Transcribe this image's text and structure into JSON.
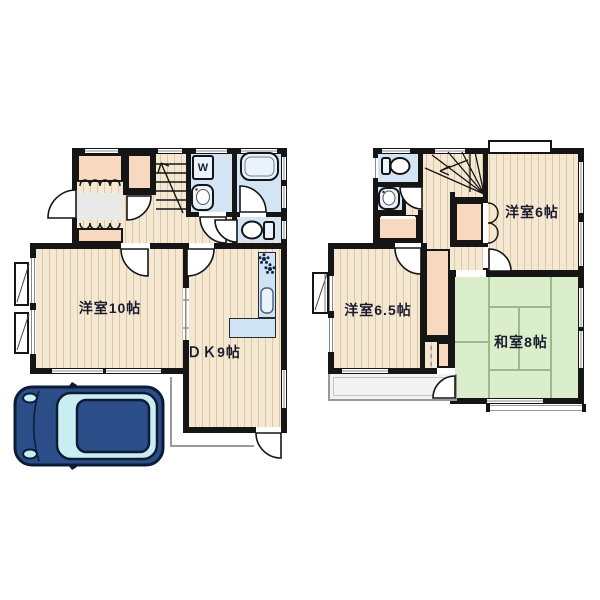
{
  "floor1": {
    "rooms": [
      {
        "id": "western-room-10",
        "label": "洋室10帖"
      },
      {
        "id": "dining-kitchen-9",
        "label": "ＤＫ9帖"
      }
    ],
    "washer_label": "W",
    "features": [
      "entrance-closets",
      "staircase-up",
      "washroom",
      "bathroom",
      "toilet",
      "kitchen-counter",
      "car-parking"
    ]
  },
  "floor2": {
    "rooms": [
      {
        "id": "western-room-6",
        "label": "洋室6帖"
      },
      {
        "id": "western-room-6-5",
        "label": "洋室6.5帖"
      },
      {
        "id": "japanese-room-8",
        "label": "和室8帖"
      }
    ],
    "features": [
      "toilet",
      "washbasin",
      "staircase-down",
      "closets",
      "balcony"
    ]
  },
  "icons": [
    "toilet-icon",
    "bathtub-icon",
    "washbasin-icon",
    "washing-machine-icon",
    "stove-icon",
    "kitchen-sink-icon",
    "stairs-icon",
    "car-top-view",
    "door-arc",
    "folding-door"
  ],
  "colors": {
    "wall": "#151515",
    "floor_base": "#f5e8d3",
    "floor_stripe": "#dcc6a5",
    "closet": "#f8d8bf",
    "wet_area": "#d3e4f4",
    "fixture_fill": "#eaf2fb",
    "tatami": "#daeecb",
    "tatami_line": "#9cb98e",
    "genkan": "#e9e9e9",
    "balcony": "#f3f3f3",
    "car_body": "#2c4e88",
    "car_glass": "#c9eef1",
    "car_outline": "#0c1c38",
    "label_text": "#1b1b30"
  }
}
